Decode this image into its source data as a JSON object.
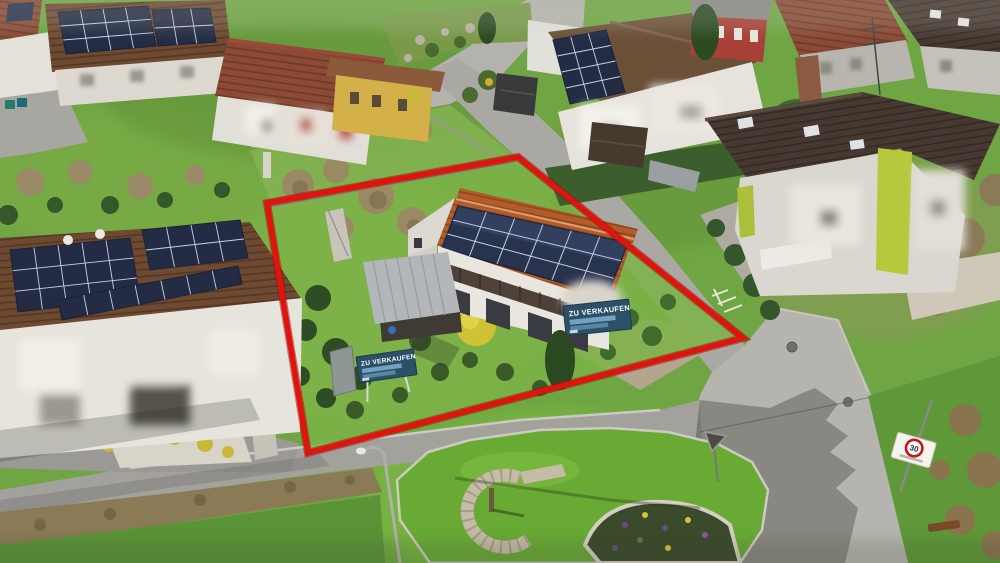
{
  "image": {
    "kind": "aerial-drone-photo",
    "subject": "Residential neighborhood; property for sale outlined in red",
    "width": 1000,
    "height": 563
  },
  "annotations": {
    "property_outline": {
      "color": "#e0140e",
      "shape": "quadrilateral",
      "points": [
        [
          267,
          203
        ],
        [
          518,
          157
        ],
        [
          743,
          338
        ],
        [
          308,
          453
        ]
      ]
    }
  },
  "signs": {
    "banner_garden": {
      "label": "ZU VERKAUFEN",
      "background": "#2b5068",
      "text_color": "#ffffff"
    },
    "banner_house": {
      "label": "ZU VERKAUFEN",
      "background": "#2b5068",
      "text_color": "#ffffff"
    },
    "speed_zone": {
      "value": "30",
      "ring_color": "#c0181c"
    }
  },
  "scene": {
    "main_house": {
      "solar_rows": 3,
      "solar_cols": 6,
      "roof_color": "#b25c2a",
      "wall_color": "#e9e6df"
    },
    "left_house": {
      "has_solar_array": true,
      "facade": "privacy-blurred"
    },
    "colors": {
      "grass": "#6fa643",
      "road": "#a8a7a3",
      "panel": "#28334e"
    },
    "features": [
      "stone spiral well on green traffic island",
      "flower bed",
      "street lamp",
      "bench",
      "yield sign"
    ]
  }
}
